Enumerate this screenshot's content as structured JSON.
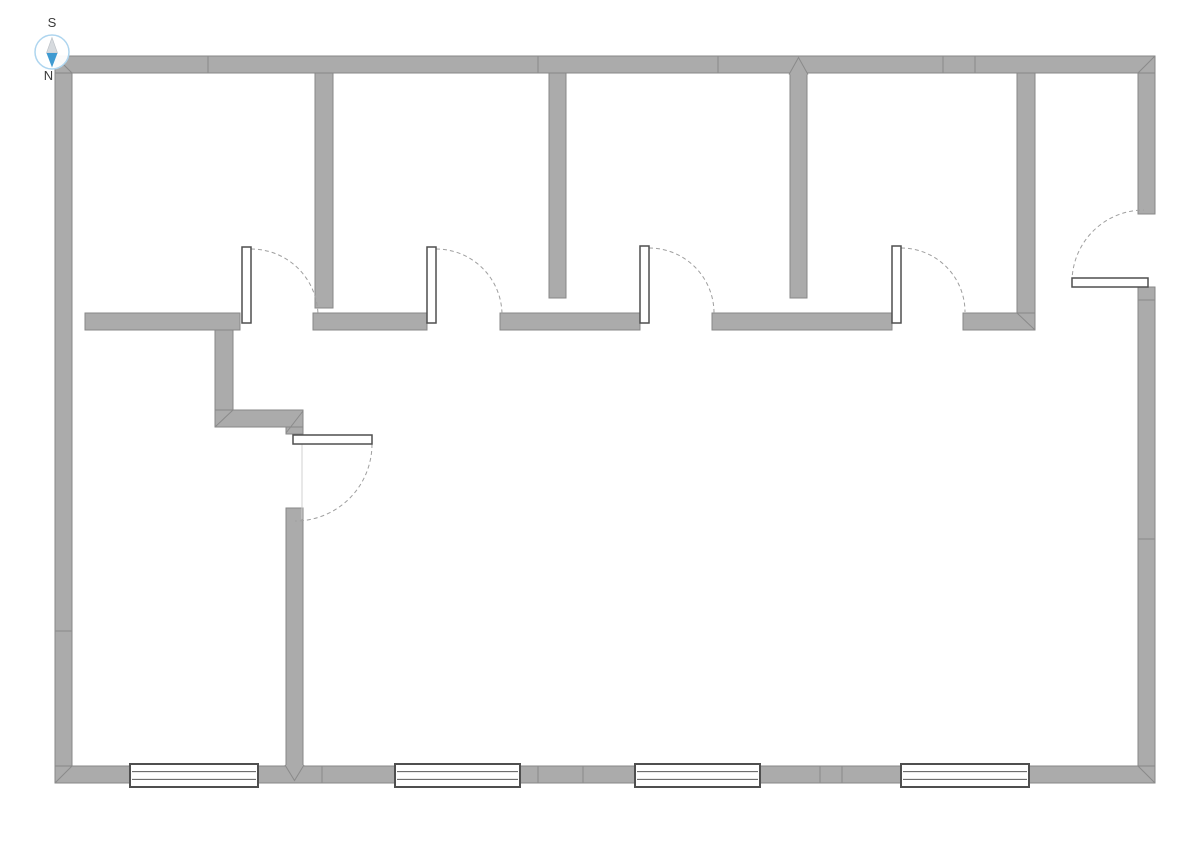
{
  "compass": {
    "label_top": "S",
    "label_bottom": "N",
    "cx": 52,
    "cy": 52,
    "r": 17,
    "ring_color": "#aed5ef",
    "needle_top_color": "#d6dade",
    "needle_top_edge": "#b9bec4",
    "needle_bottom_color": "#3f9ad1",
    "label_color": "#3a3a3a"
  },
  "plan": {
    "canvas": {
      "w": 1191,
      "h": 842,
      "background": "#ffffff"
    },
    "colors": {
      "wall_fill": "#ababab",
      "wall_edge": "#878787",
      "seam": "#8a8a8a",
      "opening_border": "#4f4f4f",
      "window_line": "#5a5a5a",
      "arc": "#9f9f9f",
      "faint_line": "#d0d0d0",
      "leaf_fill": "#ffffff"
    },
    "walls": [
      {
        "name": "exterior-wall-left",
        "x": 55,
        "y": 56,
        "w": 17,
        "h": 727
      },
      {
        "name": "exterior-wall-right-upper",
        "x": 1138,
        "y": 56,
        "w": 17,
        "h": 158
      },
      {
        "name": "exterior-wall-right-lower",
        "x": 1138,
        "y": 287,
        "w": 17,
        "h": 496
      },
      {
        "name": "exterior-wall-top",
        "x": 55,
        "y": 56,
        "w": 1100,
        "h": 17
      },
      {
        "name": "exterior-wall-bottom",
        "x": 55,
        "y": 766,
        "w": 1100,
        "h": 17
      },
      {
        "name": "room-divider-wall-4",
        "x": 1017,
        "y": 73,
        "w": 18,
        "h": 240
      },
      {
        "name": "interior-corridor-wall-1",
        "x": 85,
        "y": 313,
        "w": 155,
        "h": 17
      },
      {
        "name": "interior-corridor-wall-2",
        "x": 313,
        "y": 313,
        "w": 114,
        "h": 17
      },
      {
        "name": "interior-corridor-wall-3",
        "x": 500,
        "y": 313,
        "w": 140,
        "h": 17
      },
      {
        "name": "interior-corridor-wall-4",
        "x": 712,
        "y": 313,
        "w": 180,
        "h": 17
      },
      {
        "name": "interior-corridor-wall-5",
        "x": 963,
        "y": 313,
        "w": 72,
        "h": 17
      },
      {
        "name": "room-divider-wall-1",
        "x": 315,
        "y": 73,
        "w": 18,
        "h": 235
      },
      {
        "name": "room-divider-wall-2",
        "x": 549,
        "y": 73,
        "w": 17,
        "h": 225
      },
      {
        "name": "room-divider-wall-3",
        "x": 790,
        "y": 73,
        "w": 17,
        "h": 225
      },
      {
        "name": "step-wall-vertical",
        "x": 215,
        "y": 330,
        "w": 18,
        "h": 97
      },
      {
        "name": "step-wall-horizontal",
        "x": 215,
        "y": 410,
        "w": 88,
        "h": 17
      },
      {
        "name": "step-wall-corner-stub",
        "x": 286,
        "y": 427,
        "w": 17,
        "h": 7
      },
      {
        "name": "lower-vertical-wall",
        "x": 286,
        "y": 508,
        "w": 17,
        "h": 258
      }
    ],
    "miters": [
      {
        "x1": 55,
        "y1": 56,
        "x2": 72,
        "y2": 73
      },
      {
        "x1": 1155,
        "y1": 56,
        "x2": 1138,
        "y2": 73
      },
      {
        "x1": 55,
        "y1": 783,
        "x2": 72,
        "y2": 766
      },
      {
        "x1": 1138,
        "y1": 766,
        "x2": 1155,
        "y2": 783
      },
      {
        "x1": 215,
        "y1": 427,
        "x2": 233,
        "y2": 410
      },
      {
        "x1": 286,
        "y1": 433,
        "x2": 303,
        "y2": 411
      },
      {
        "x1": 1017,
        "y1": 313,
        "x2": 1035,
        "y2": 330
      }
    ],
    "seams": [
      {
        "x1": 208,
        "y1": 56,
        "x2": 208,
        "y2": 73
      },
      {
        "x1": 538,
        "y1": 56,
        "x2": 538,
        "y2": 73
      },
      {
        "x1": 718,
        "y1": 56,
        "x2": 718,
        "y2": 73
      },
      {
        "x1": 943,
        "y1": 56,
        "x2": 943,
        "y2": 73
      },
      {
        "x1": 975,
        "y1": 56,
        "x2": 975,
        "y2": 73
      },
      {
        "x1": 322,
        "y1": 766,
        "x2": 322,
        "y2": 783
      },
      {
        "x1": 538,
        "y1": 766,
        "x2": 538,
        "y2": 783
      },
      {
        "x1": 583,
        "y1": 766,
        "x2": 583,
        "y2": 783
      },
      {
        "x1": 820,
        "y1": 766,
        "x2": 820,
        "y2": 783
      },
      {
        "x1": 842,
        "y1": 766,
        "x2": 842,
        "y2": 783
      },
      {
        "x1": 55,
        "y1": 631,
        "x2": 72,
        "y2": 631
      },
      {
        "x1": 1138,
        "y1": 300,
        "x2": 1155,
        "y2": 300
      },
      {
        "x1": 1138,
        "y1": 539,
        "x2": 1155,
        "y2": 539
      }
    ],
    "v_joints": [
      {
        "d": "M 789,74.5 L 798.5,57.5 L 808,74.5"
      },
      {
        "d": "M 285,765 L 294.5,780.5 L 304,765"
      }
    ],
    "windows": [
      {
        "name": "window-1",
        "x": 130,
        "y": 764,
        "w": 128,
        "h": 23
      },
      {
        "name": "window-2",
        "x": 395,
        "y": 764,
        "w": 125,
        "h": 23
      },
      {
        "name": "window-3",
        "x": 635,
        "y": 764,
        "w": 125,
        "h": 23
      },
      {
        "name": "window-4",
        "x": 901,
        "y": 764,
        "w": 128,
        "h": 23
      }
    ],
    "doors": [
      {
        "name": "room-door-1",
        "leaf": {
          "x": 242,
          "y": 247,
          "w": 9,
          "h": 76
        },
        "arc": "M 251,249 A 67,67 0 0 1 318,316"
      },
      {
        "name": "room-door-2",
        "leaf": {
          "x": 427,
          "y": 247,
          "w": 9,
          "h": 76
        },
        "arc": "M 436,249 A 66,66 0 0 1 502,315"
      },
      {
        "name": "room-door-3",
        "leaf": {
          "x": 640,
          "y": 246,
          "w": 9,
          "h": 77
        },
        "arc": "M 649,248 A 65,65 0 0 1 714,313"
      },
      {
        "name": "room-door-4",
        "leaf": {
          "x": 892,
          "y": 246,
          "w": 9,
          "h": 77
        },
        "arc": "M 901,248 A 64,64 0 0 1 965,312"
      },
      {
        "name": "room-door-left",
        "leaf": {
          "x": 293,
          "y": 435,
          "w": 79,
          "h": 9
        },
        "arc": "M 372,444 A 77,77 0 0 1 295,521",
        "jamb_line": {
          "x1": 302,
          "y1": 444,
          "x2": 302,
          "y2": 519
        }
      },
      {
        "name": "entry-door-right",
        "leaf": {
          "x": 1072,
          "y": 278,
          "w": 76,
          "h": 9
        },
        "arc": "M 1072,282 A 72,72 0 0 1 1144,210"
      }
    ]
  }
}
